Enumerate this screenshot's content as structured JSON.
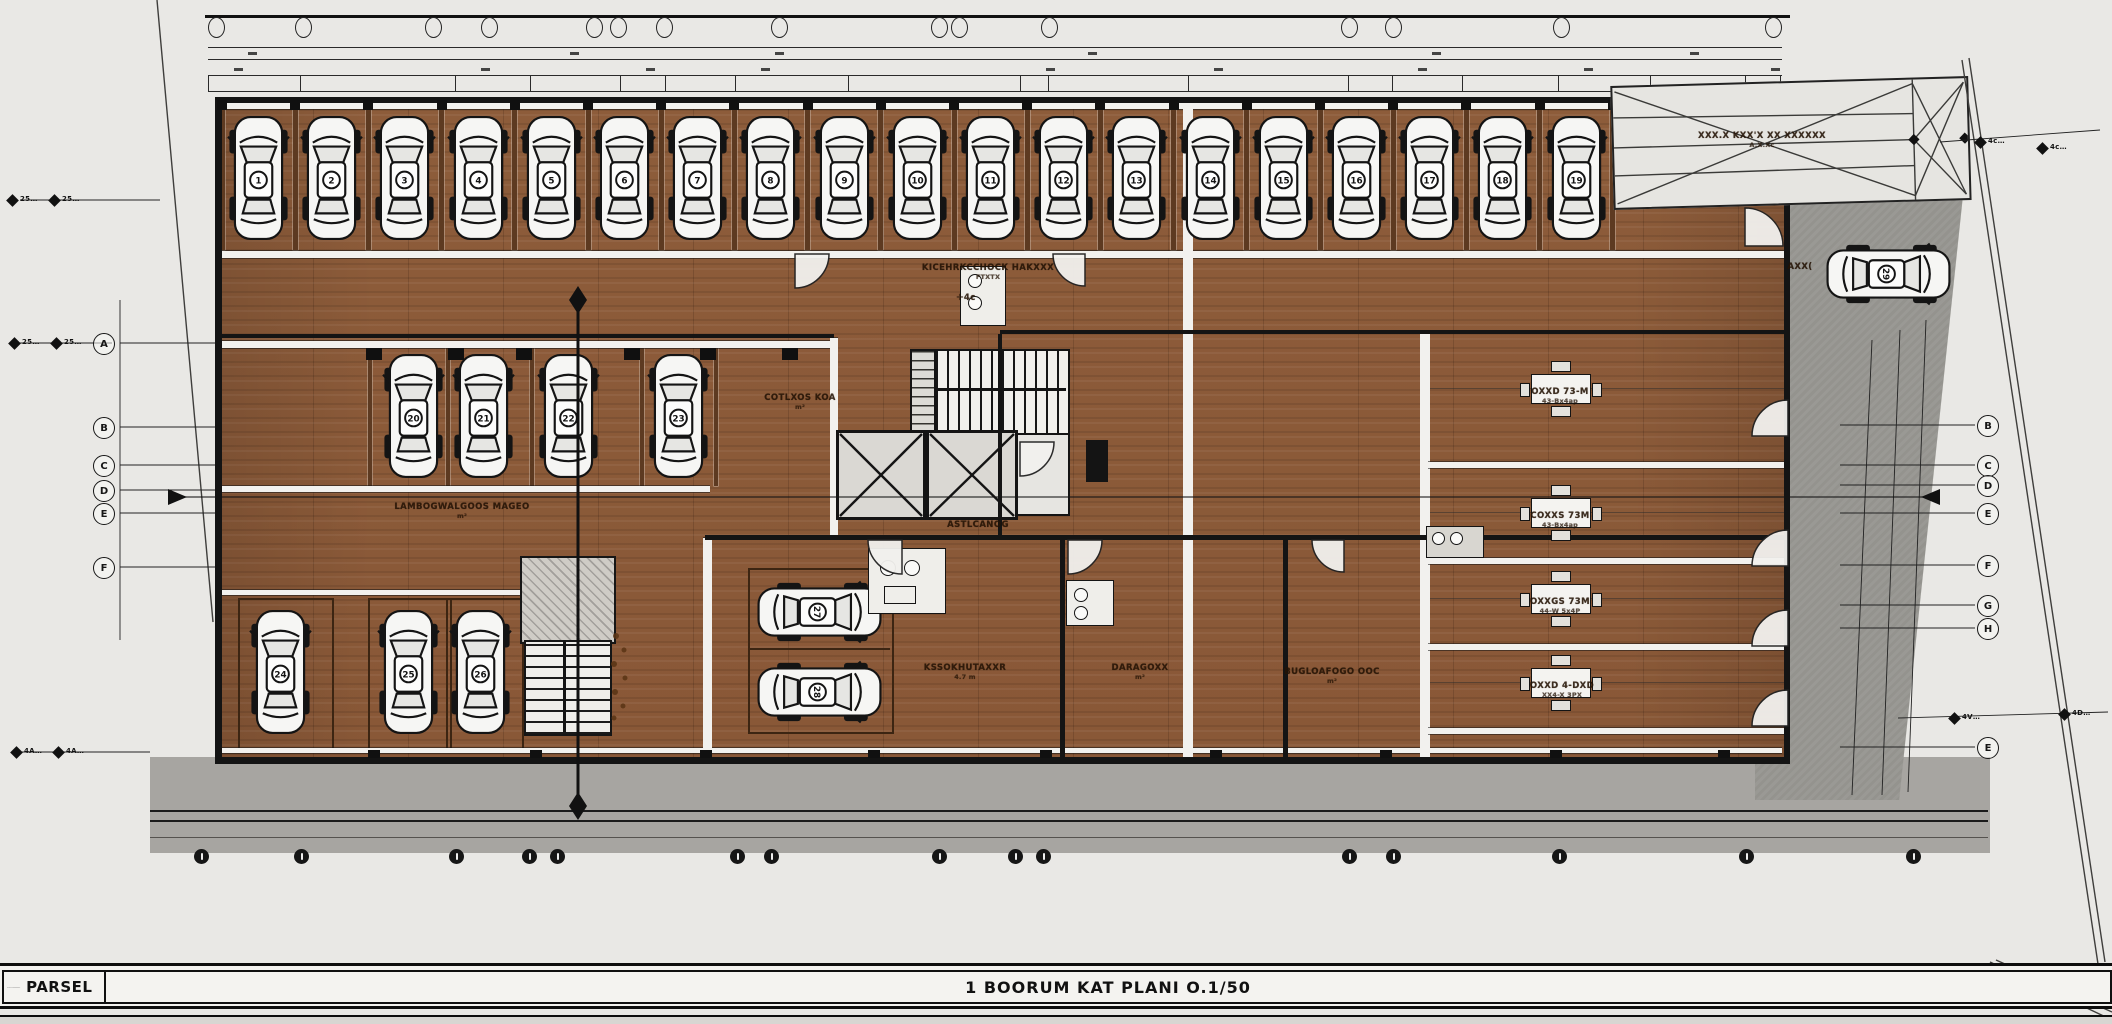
{
  "sheet": {
    "parsel_label": "PARSEL",
    "title": "1 BOORUM  KAT PLANI O.1/50",
    "left_stamp": "............"
  },
  "plan": {
    "labels": [
      {
        "id": "aisle-room-label",
        "text": "KICEHRKCCHOCK HAKXXX",
        "sub": "FTXTX",
        "x": 988,
        "y": 272
      },
      {
        "id": "aisle-mark",
        "text": "✛4c",
        "sub": "",
        "x": 966,
        "y": 298
      },
      {
        "id": "row3-area-label",
        "text": "LAMBOGWALGOOS MAGEO",
        "sub": "m²",
        "x": 462,
        "y": 511
      },
      {
        "id": "small-room-label",
        "text": "COTLXOS KOA",
        "sub": "m²",
        "x": 800,
        "y": 402
      },
      {
        "id": "core-label",
        "text": "ASTLCANOG",
        "sub": "",
        "x": 978,
        "y": 525
      },
      {
        "id": "room-b-label",
        "text": "KSSOKHUTAXXR",
        "sub": "4.7 m",
        "x": 965,
        "y": 672
      },
      {
        "id": "room-c-label",
        "text": "DARAGOXX",
        "sub": "m²",
        "x": 1140,
        "y": 672
      },
      {
        "id": "room-d-label",
        "text": "BUGLOAFOGO OOC",
        "sub": "m²",
        "x": 1332,
        "y": 676
      },
      {
        "id": "ramp-label",
        "text": "XXX.X KXX'X XX XXXXXX",
        "sub": "A.X.Xc",
        "x": 1762,
        "y": 140
      },
      {
        "id": "drive-car-label",
        "text": "AXX(",
        "sub": "",
        "x": 1800,
        "y": 267
      },
      {
        "id": "office-1-label",
        "text": "OXXD 73-M",
        "sub": "43-Bx4ap",
        "x": 1560,
        "y": 396
      },
      {
        "id": "office-2-label",
        "text": "COXXS 73M",
        "sub": "43-Bx4ap",
        "x": 1560,
        "y": 520
      },
      {
        "id": "office-3-label",
        "text": "OXXGS 73M",
        "sub": "44-W 5x4P",
        "x": 1560,
        "y": 606
      },
      {
        "id": "office-4-label",
        "text": "OXXD 4-DXD",
        "sub": "XX4-X 3PX",
        "x": 1562,
        "y": 690
      }
    ],
    "parking": {
      "top_row": {
        "count": 19,
        "numbers": [
          1,
          2,
          3,
          4,
          5,
          6,
          7,
          8,
          9,
          10,
          11,
          12,
          13,
          14,
          15,
          16,
          17,
          18,
          19
        ]
      },
      "mid_row": {
        "count": 4,
        "numbers": [
          20,
          21,
          22,
          23
        ]
      },
      "bottom_left": {
        "count": 3,
        "numbers": [
          24,
          25,
          26
        ]
      },
      "center_pair": {
        "count": 2,
        "numbers": [
          27,
          28
        ]
      },
      "driveway": {
        "count": 1,
        "numbers": [
          29
        ]
      }
    },
    "axes": {
      "left": [
        "A",
        "B",
        "C",
        "D",
        "E",
        "F"
      ],
      "right": [
        "B",
        "C",
        "D",
        "E",
        "F",
        "G",
        "H",
        "E"
      ],
      "bottom_count": 15,
      "dim_marks": [
        {
          "t": "25",
          "x": 8,
          "y": 196
        },
        {
          "t": "25",
          "x": 50,
          "y": 196
        },
        {
          "t": "25",
          "x": 10,
          "y": 339
        },
        {
          "t": "25",
          "x": 52,
          "y": 339
        },
        {
          "t": "4A",
          "x": 12,
          "y": 748
        },
        {
          "t": "4A",
          "x": 54,
          "y": 748
        },
        {
          "t": "4c",
          "x": 1976,
          "y": 138
        },
        {
          "t": "4c",
          "x": 2038,
          "y": 144
        },
        {
          "t": "4V",
          "x": 1950,
          "y": 714
        },
        {
          "t": "4D",
          "x": 2060,
          "y": 710
        }
      ]
    }
  },
  "colors": {
    "floor_wood": "#8d5c3a",
    "stall_divider": "#5d3a21",
    "walls": "#141414",
    "driveway_gray": "#94938e",
    "apron_gray": "#a7a5a1",
    "ramp_fill": "#e6e5e1",
    "background": "#e9e8e5"
  }
}
